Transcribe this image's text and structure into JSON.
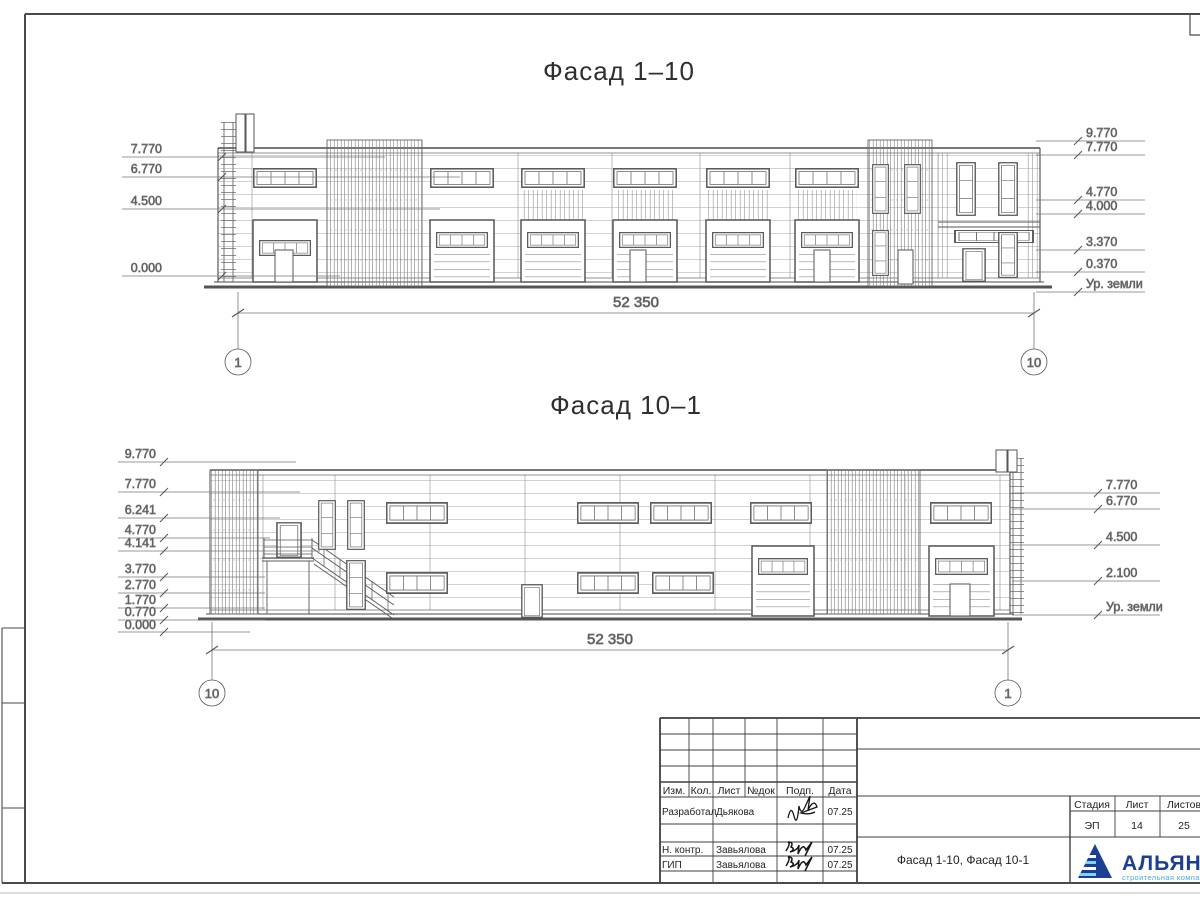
{
  "facade1": {
    "title": "Фасад 1–10",
    "left_marks": [
      "7.770",
      "6.770",
      "4.500",
      "0.000"
    ],
    "right_marks": [
      "9.770",
      "7.770",
      "4.770",
      "4.000",
      "3.370",
      "0.370"
    ],
    "ground_label": "Ур. земли",
    "span_dim": "52 350",
    "axis_left": "1",
    "axis_right": "10"
  },
  "facade2": {
    "title": "Фасад 10–1",
    "left_marks": [
      "9.770",
      "7.770",
      "6.241",
      "4.770",
      "4.141",
      "3.770",
      "2.770",
      "1.770",
      "0.770",
      "0.000"
    ],
    "right_marks": [
      "7.770",
      "6.770",
      "4.500",
      "2.100"
    ],
    "ground_label": "Ур. земли",
    "span_dim": "52 350",
    "axis_left": "10",
    "axis_right": "1"
  },
  "titleblock": {
    "header_cols": [
      "Изм.",
      "Кол.",
      "Лист",
      "№док",
      "Подп.",
      "Дата"
    ],
    "rows": [
      {
        "role": "Разработал",
        "name": "Дьякова",
        "date": "07.25"
      },
      {
        "role": "Н. контр.",
        "name": "Завьялова",
        "date": "07.25"
      },
      {
        "role": "ГИП",
        "name": "Завьялова",
        "date": "07.25"
      }
    ],
    "doc_title": "Фасад 1-10, Фасад 10-1",
    "stage_label": "Стадия",
    "sheet_label": "Лист",
    "sheets_label": "Листов",
    "stage_value": "ЭП",
    "sheet_value": "14",
    "sheets_value": "25",
    "logo": {
      "text": "АЛЬЯНС",
      "subtitle": "строительная компания",
      "color_primary": "#1c3f94",
      "color_accent": "#41aee1"
    }
  }
}
